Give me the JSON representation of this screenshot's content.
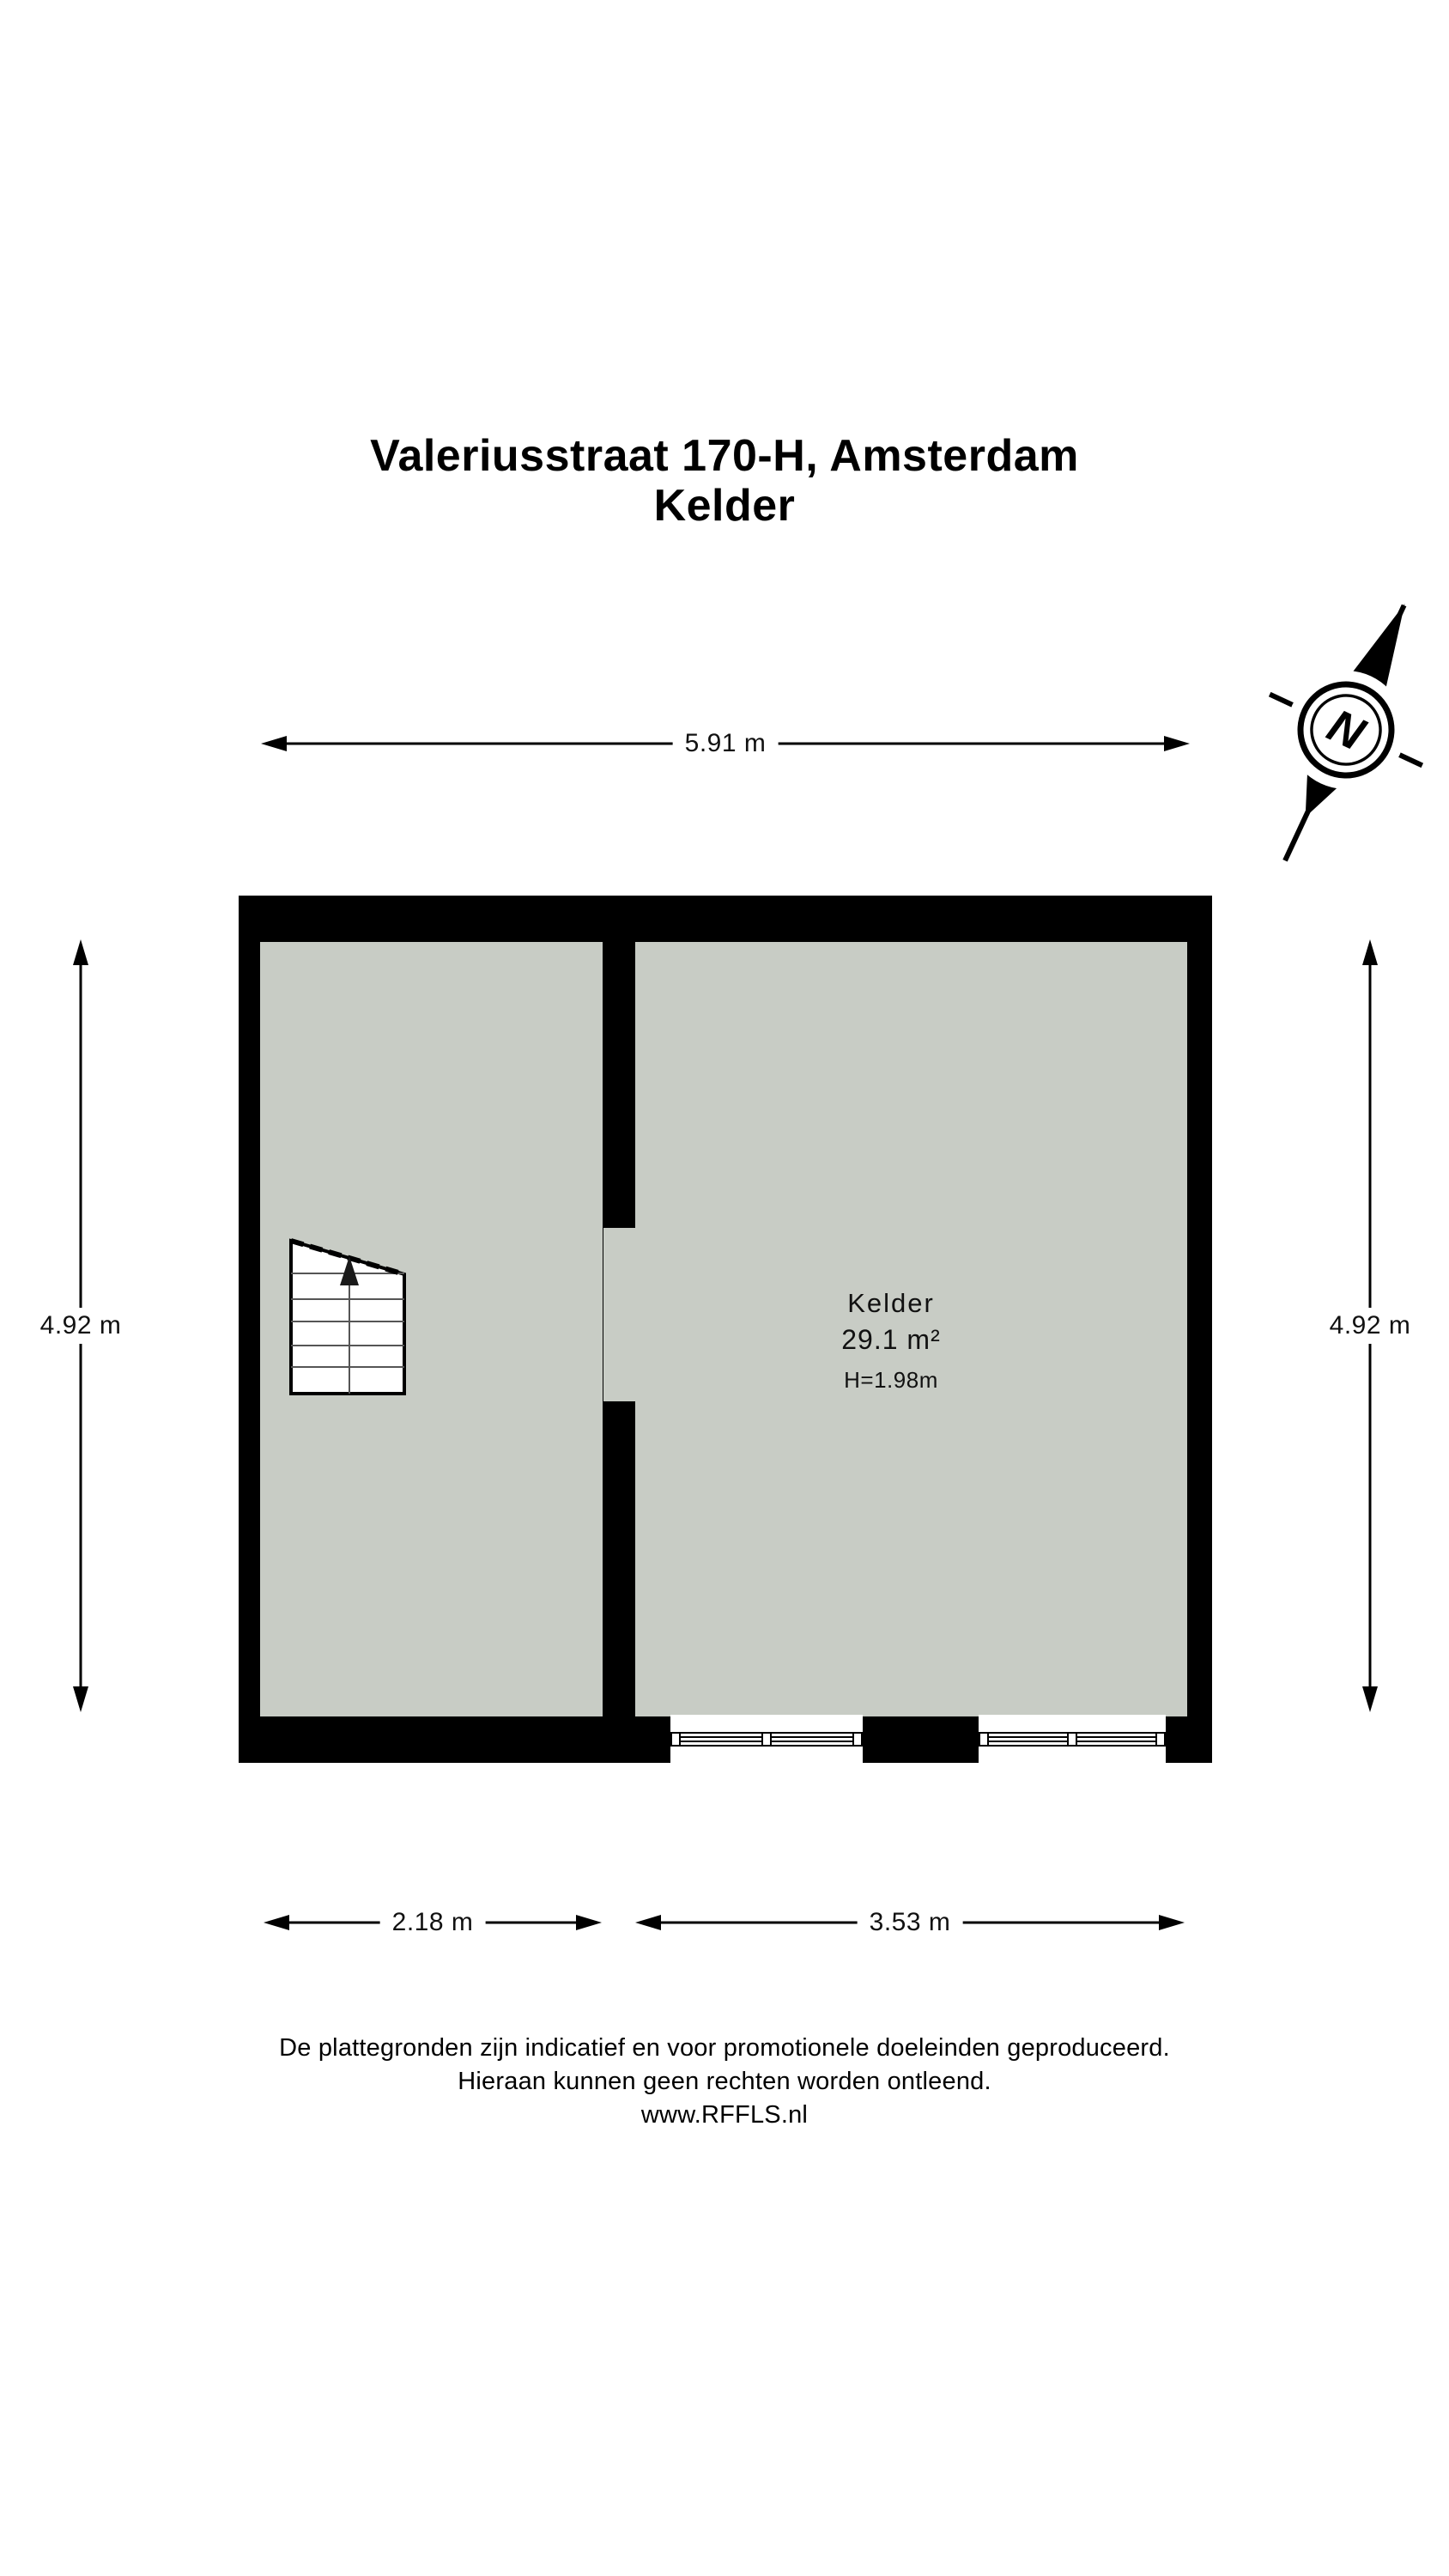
{
  "title": {
    "line1": "Valeriusstraat 170-H, Amsterdam",
    "line2": "Kelder"
  },
  "compass": {
    "label": "N"
  },
  "dimensions": {
    "top": "5.91 m",
    "left": "4.92 m",
    "right": "4.92 m",
    "bottom_left": "2.18 m",
    "bottom_right": "3.53 m"
  },
  "room": {
    "name": "Kelder",
    "area": "29.1 m²",
    "height": "H=1.98m"
  },
  "footer": {
    "line1": "De plattegronden zijn indicatief en voor promotionele doeleinden geproduceerd.",
    "line2": "Hieraan kunnen geen rechten worden ontleend.",
    "line3": "www.RFFLS.nl"
  },
  "colors": {
    "wall": "#000000",
    "floor": "#c8ccc5",
    "background": "#ffffff"
  }
}
